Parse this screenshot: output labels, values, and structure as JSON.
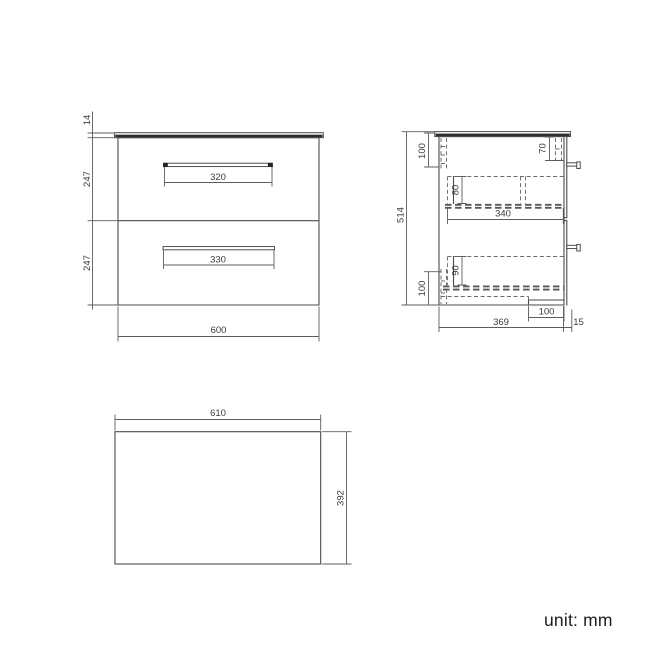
{
  "unit_note": "unit: mm",
  "front_view": {
    "worktop_thickness": "14",
    "upper_drawer_height": "247",
    "lower_drawer_height": "247",
    "upper_handle_width": "320",
    "lower_handle_width": "330",
    "overall_width": "600"
  },
  "side_view": {
    "overall_height": "514",
    "top_back_rail": "100",
    "top_front_rail": "70",
    "upper_drawer_inner_depth": "80",
    "drawer_length": "340",
    "lower_drawer_inner_depth": "90",
    "bottom_back_rail": "100",
    "bottom_recess": "100",
    "overall_depth": "369",
    "handle_projection": "15"
  },
  "top_view": {
    "overall_width": "610",
    "overall_depth": "392"
  },
  "colors": {
    "line": "#4a4a4a",
    "hidden_line": "#6b6b6b",
    "worktop": "#2d2d2d",
    "text": "#3c3c3c",
    "background": "#ffffff"
  }
}
